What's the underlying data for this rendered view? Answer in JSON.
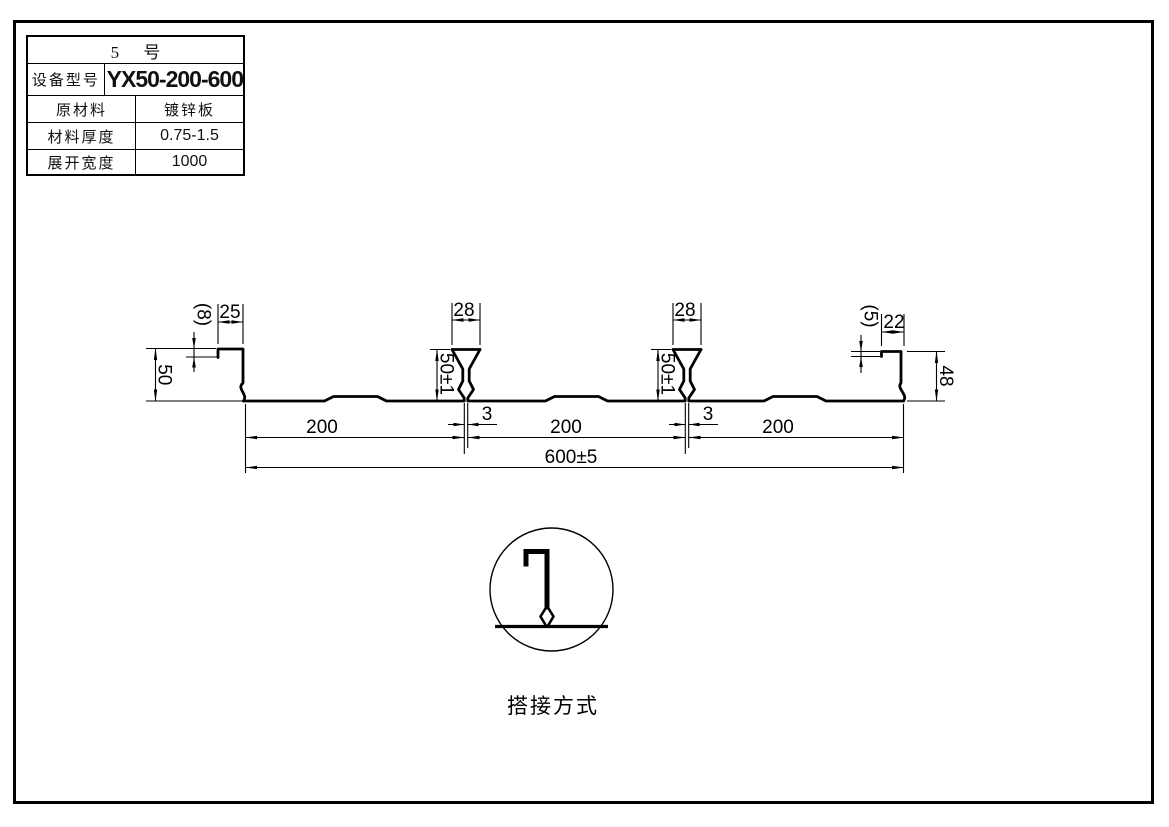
{
  "table": {
    "title": "5 号",
    "rows": [
      {
        "label": "设备型号",
        "value": "YX50-200-600"
      },
      {
        "label": "原材料",
        "value": "镀锌板"
      },
      {
        "label": "材料厚度",
        "value": "0.75-1.5"
      },
      {
        "label": "展开宽度",
        "value": "1000"
      }
    ]
  },
  "drawing": {
    "dims": {
      "left_step": "(8)",
      "left_lip_width": "25",
      "left_height": "50",
      "rib1_top_width": "28",
      "rib1_height": "50±1",
      "rib1_stem_width": "3",
      "rib2_top_width": "28",
      "rib2_height": "50±1",
      "rib2_stem_width": "3",
      "right_step": "(5)",
      "right_lip_width": "22",
      "right_height": "48",
      "pitch1": "200",
      "pitch2": "200",
      "pitch3": "200",
      "overall_width": "600±5"
    },
    "detail": {
      "caption": "搭接方式"
    }
  },
  "colors": {
    "line": "#000000",
    "background": "#ffffff"
  }
}
